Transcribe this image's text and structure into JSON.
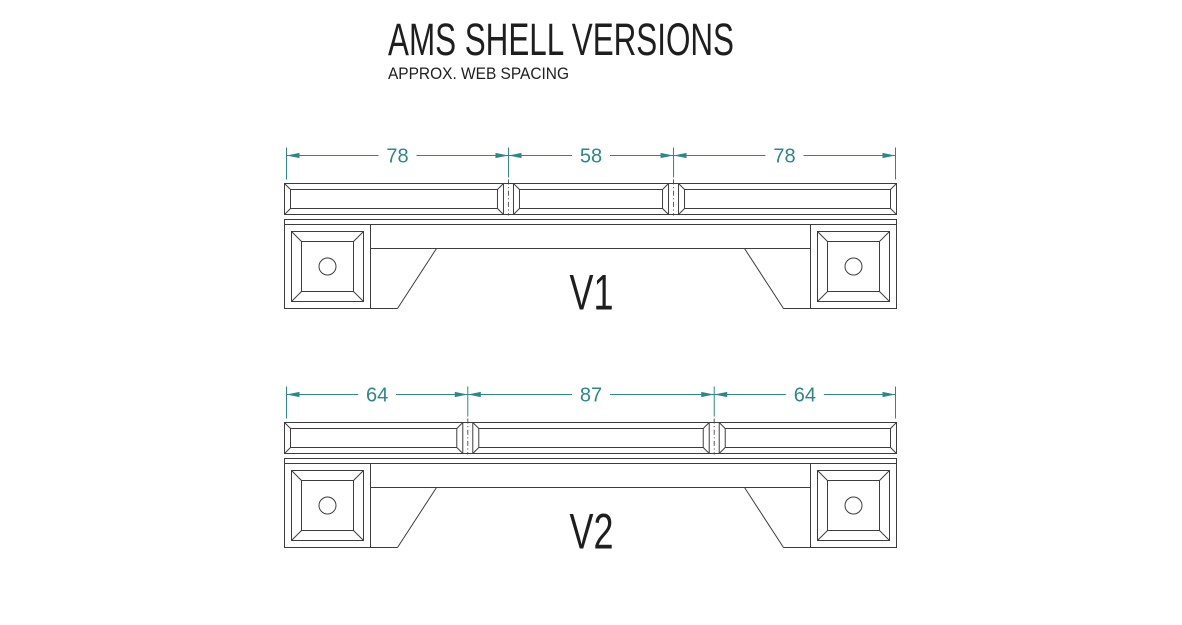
{
  "title": "AMS SHELL VERSIONS",
  "subtitle": "APPROX. WEB SPACING",
  "colors": {
    "background": "#ffffff",
    "line": "#3d3d3d",
    "centerline": "#5a5a5a",
    "dimension": "#2e8787",
    "text": "#1e1e1e"
  },
  "versions": [
    {
      "label": "V1",
      "web_spacings": [
        78,
        58,
        78
      ]
    },
    {
      "label": "V2",
      "web_spacings": [
        64,
        87,
        64
      ]
    }
  ]
}
